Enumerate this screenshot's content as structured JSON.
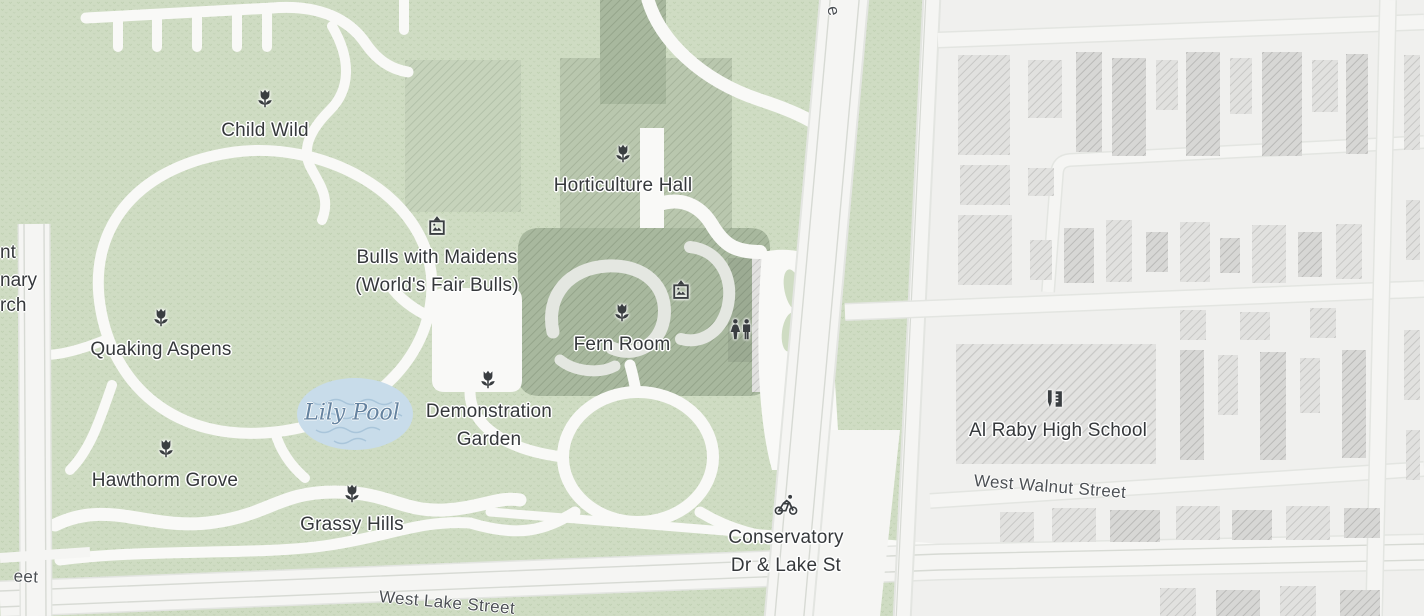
{
  "map": {
    "kind": "park-and-neighborhood-map",
    "colors": {
      "park_green": "#cfdcc3",
      "park_texture": "#b3c6a4",
      "building_green_light": "#c6d3bb",
      "building_green": "#b9c7ae",
      "building_green_dark": "#a8b89e",
      "building_green_darker": "#9cab93",
      "path_white": "#f9f9f7",
      "road_white": "#f5f5f3",
      "road_casing": "#e3e5e1",
      "road_line": "#d7dad4",
      "urban_background": "#f0f0ee",
      "building_gray": "#e1e1df",
      "building_gray_dark": "#d7d7d5",
      "water_fill": "#c8dcea",
      "water_wave": "#a9c5da",
      "water_label_color": "#64829f",
      "poi_label_color": "#35383b",
      "street_label_color": "#4c5054",
      "icon_color": "#3a3e41",
      "label_halo": "#ffffff"
    },
    "pois": [
      {
        "id": "child-wild",
        "lines": [
          "Child Wild"
        ],
        "x": 265,
        "y": 131,
        "icon": "flower",
        "icon_x": 265,
        "icon_y": 99
      },
      {
        "id": "horticulture-hall",
        "lines": [
          "Horticulture Hall"
        ],
        "x": 623,
        "y": 186,
        "icon": "flower",
        "icon_x": 623,
        "icon_y": 154
      },
      {
        "id": "bulls-with-maidens",
        "lines": [
          "Bulls with Maidens",
          "(World's Fair Bulls)"
        ],
        "x": 437,
        "y": 272,
        "icon": "art",
        "icon_x": 437,
        "icon_y": 227
      },
      {
        "id": "quaking-aspens",
        "lines": [
          "Quaking Aspens"
        ],
        "x": 161,
        "y": 350,
        "icon": "flower",
        "icon_x": 161,
        "icon_y": 318
      },
      {
        "id": "fern-room",
        "lines": [
          "Fern Room"
        ],
        "x": 622,
        "y": 345,
        "icon": "flower",
        "icon_x": 622,
        "icon_y": 313
      },
      {
        "id": "fern-room-gallery",
        "lines": [],
        "icon": "art",
        "icon_x": 681,
        "icon_y": 291
      },
      {
        "id": "fern-room-restroom",
        "lines": [],
        "icon": "restroom",
        "icon_x": 741,
        "icon_y": 330
      },
      {
        "id": "demonstration-garden",
        "lines": [
          "Demonstration",
          "Garden"
        ],
        "x": 489,
        "y": 426,
        "icon": "flower",
        "icon_x": 488,
        "icon_y": 380
      },
      {
        "id": "hawthorm-grove",
        "lines": [
          "Hawthorm Grove"
        ],
        "x": 165,
        "y": 481,
        "icon": "flower",
        "icon_x": 166,
        "icon_y": 449
      },
      {
        "id": "grassy-hills",
        "lines": [
          "Grassy Hills"
        ],
        "x": 352,
        "y": 525,
        "icon": "flower",
        "icon_x": 352,
        "icon_y": 494
      },
      {
        "id": "conservatory-dr-lake-st",
        "lines": [
          "Conservatory",
          "Dr & Lake St"
        ],
        "x": 786,
        "y": 552,
        "icon": "bike",
        "icon_x": 786,
        "icon_y": 505
      },
      {
        "id": "al-raby-high-school",
        "lines": [
          "Al Raby High School"
        ],
        "x": 1058,
        "y": 431,
        "icon": "school",
        "icon_x": 1055,
        "icon_y": 399
      }
    ],
    "water_features": [
      {
        "id": "lily-pool",
        "label": "Lily Pool",
        "x": 352,
        "y": 413
      }
    ],
    "street_labels": [
      {
        "id": "west-walnut-street",
        "label": "West Walnut Street",
        "x": 1050,
        "y": 487,
        "rotation": 4.5
      },
      {
        "id": "west-lake-street",
        "label": "West Lake Street",
        "x": 447,
        "y": 603,
        "rotation": 5
      },
      {
        "id": "street-partial-top",
        "label": "e",
        "x": 833,
        "y": 11,
        "rotation": 78
      },
      {
        "id": "street-partial-bottom-left",
        "label": "eet",
        "x": 26,
        "y": 577,
        "rotation": 3
      }
    ],
    "edge_label_fragments": [
      {
        "id": "edge-fragment-1",
        "label": "nt",
        "left": 0,
        "y": 253
      },
      {
        "id": "edge-fragment-2",
        "label": "nary",
        "left": 0,
        "y": 281
      },
      {
        "id": "edge-fragment-3",
        "label": "rch",
        "left": 0,
        "y": 306
      }
    ]
  }
}
